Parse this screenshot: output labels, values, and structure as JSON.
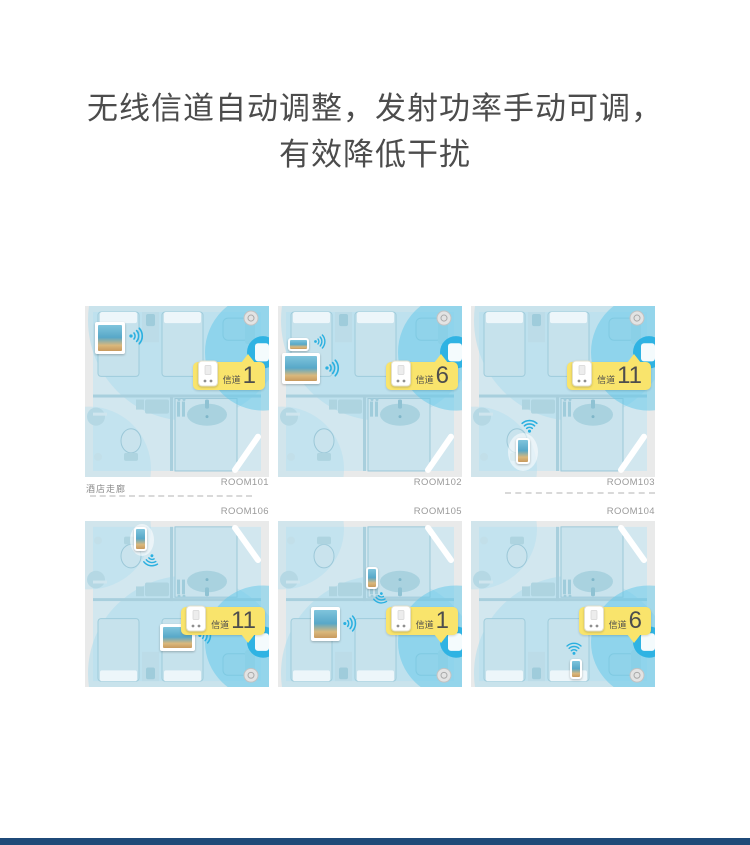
{
  "title": {
    "line1": "无线信道自动调整，发射功率手动可调，",
    "line2": "有效降低干扰"
  },
  "corridor_label": "酒店走廊",
  "channel_label": "信道",
  "accent_colors": {
    "badge_yellow": "#f9e46c",
    "wifi_blue": "#2bb0e0",
    "coverage_blue": "#5fc8e9",
    "footer_navy": "#1f4a78"
  },
  "rooms": [
    {
      "id": "ROOM101",
      "channel": "1"
    },
    {
      "id": "ROOM102",
      "channel": "6"
    },
    {
      "id": "ROOM103",
      "channel": "11"
    },
    {
      "id": "ROOM106",
      "channel": "11"
    },
    {
      "id": "ROOM105",
      "channel": "1"
    },
    {
      "id": "ROOM104",
      "channel": "6"
    }
  ]
}
